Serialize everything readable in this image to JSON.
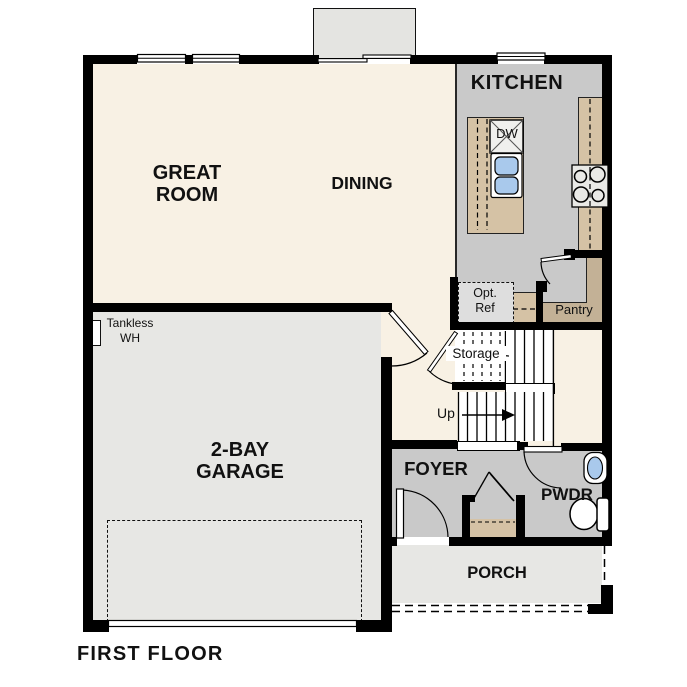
{
  "title": "FIRST FLOOR",
  "rooms": {
    "great_room": "GREAT\nROOM",
    "dining": "DINING",
    "kitchen": "KITCHEN",
    "garage": "2-BAY\nGARAGE",
    "foyer": "FOYER",
    "powder": "PWDR",
    "porch": "PORCH",
    "pantry": "Pantry",
    "storage": "Storage"
  },
  "annotations": {
    "stairs_direction": "Up",
    "tankless_water_heater": "Tankless\nWH",
    "optional_refrigerator": "Opt.\nRef",
    "dishwasher": "DW"
  },
  "colors": {
    "wall": "#000000",
    "floor_cream": "#f8f1e4",
    "floor_gray": "#c9c9c9",
    "floor_light_gray": "#e7e7e4",
    "counter_tan": "#d5c2a5",
    "pantry_tan": "#c3b196",
    "sink_blue": "#a9c9ec",
    "background": "#ffffff"
  }
}
